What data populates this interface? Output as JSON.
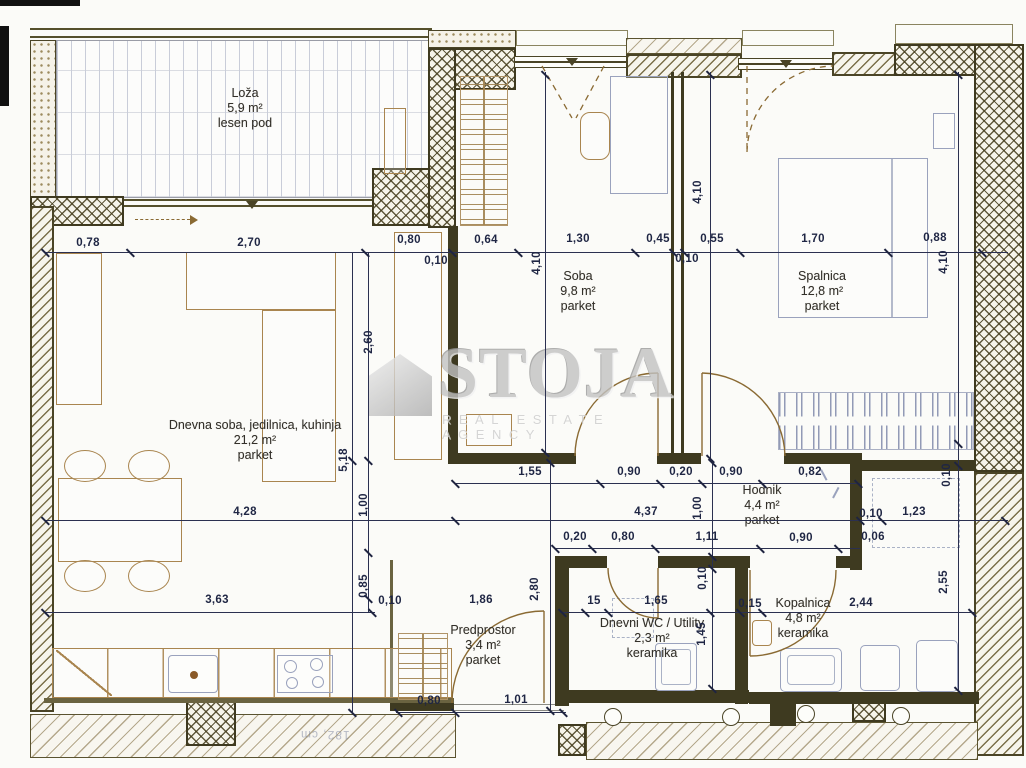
{
  "watermark": {
    "brand": "STOJA",
    "tagline": "REAL ESTATE AGENCY"
  },
  "rooms": [
    {
      "id": "loza",
      "name": "Loža",
      "area": "5,9 m²",
      "floor": "lesen pod"
    },
    {
      "id": "dnevna",
      "name": "Dnevna soba, jedilnica, kuhinja",
      "area": "21,2 m²",
      "floor": "parket"
    },
    {
      "id": "soba",
      "name": "Soba",
      "area": "9,8 m²",
      "floor": "parket"
    },
    {
      "id": "spalnica",
      "name": "Spalnica",
      "area": "12,8 m²",
      "floor": "parket"
    },
    {
      "id": "hodnik",
      "name": "Hodnik",
      "area": "4,4 m²",
      "floor": "parket"
    },
    {
      "id": "predprostor",
      "name": "Predprostor",
      "area": "3,4 m²",
      "floor": "parket"
    },
    {
      "id": "wc",
      "name": "Dnevni WC / Utility",
      "area": "2,3 m²",
      "floor": "keramika"
    },
    {
      "id": "kopalnica",
      "name": "Kopalnica",
      "area": "4,8 m²",
      "floor": "keramika"
    }
  ],
  "dimensions": {
    "labels": [
      "0,78",
      "2,70",
      "0,80",
      "0,64",
      "1,30",
      "0,45",
      "0,55",
      "1,70",
      "0,88",
      "0,10",
      "0,10",
      "4,10",
      "4,10",
      "4,10",
      "2,60",
      "5,18",
      "1,00",
      "0,85",
      "0,10",
      "1,55",
      "0,90",
      "0,20",
      "0,90",
      "0,82",
      "4,28",
      "4,37",
      "1,00",
      "0,10",
      "1,23",
      "0,06",
      "0,20",
      "0,80",
      "1,11",
      "0,90",
      "0,10",
      "2,55",
      "0,10",
      "1,45",
      "2,80",
      "3,63",
      "1,86",
      "15",
      "1,65",
      "0,15",
      "2,44",
      "0,80",
      "1,01"
    ]
  },
  "artifact_text": "182, cm"
}
